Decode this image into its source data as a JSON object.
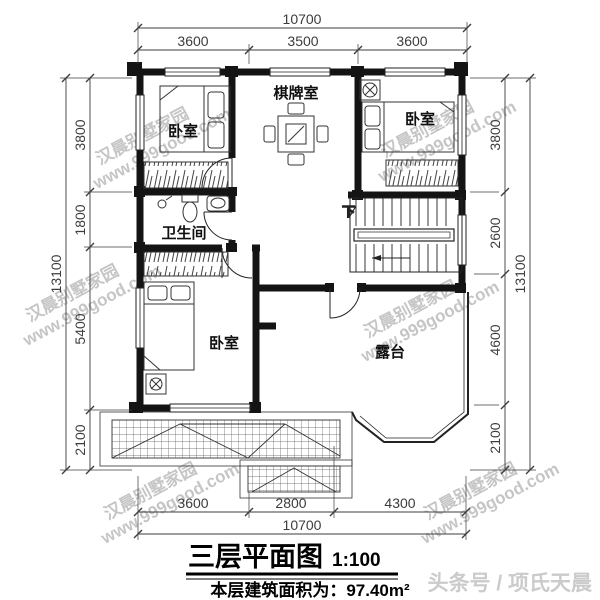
{
  "title_block": {
    "title": "三层平面图",
    "scale": "1:100",
    "area": "本层建筑面积为：97.40m²"
  },
  "footer": {
    "credit": "头条号 / 项氏天晨"
  },
  "watermark": {
    "line1": "汉晨别墅家园",
    "line2": "www.999good.com"
  },
  "rooms": {
    "bedroom_top_left": "卧室",
    "game_room": "棋牌室",
    "bedroom_top_right": "卧室",
    "bathroom": "卫生间",
    "bedroom_bottom_left": "卧室",
    "terrace": "露台",
    "stairs_down": "下"
  },
  "dimensions": {
    "top": {
      "total": "10700",
      "segments": [
        "3600",
        "3500",
        "3600"
      ]
    },
    "bottom": {
      "total": "10700",
      "segments": [
        "3600",
        "2800",
        "4300"
      ]
    },
    "left": {
      "total": "13100",
      "segments": [
        "3800",
        "1800",
        "5400",
        "2100"
      ]
    },
    "right": {
      "total": "13100",
      "segments": [
        "3800",
        "2600",
        "4600",
        "2100"
      ]
    }
  },
  "colors": {
    "ink": "#141414",
    "dim_line": "#3c3c3c",
    "watermark": "#8d8d8d",
    "credit": "#cbcbcb"
  }
}
